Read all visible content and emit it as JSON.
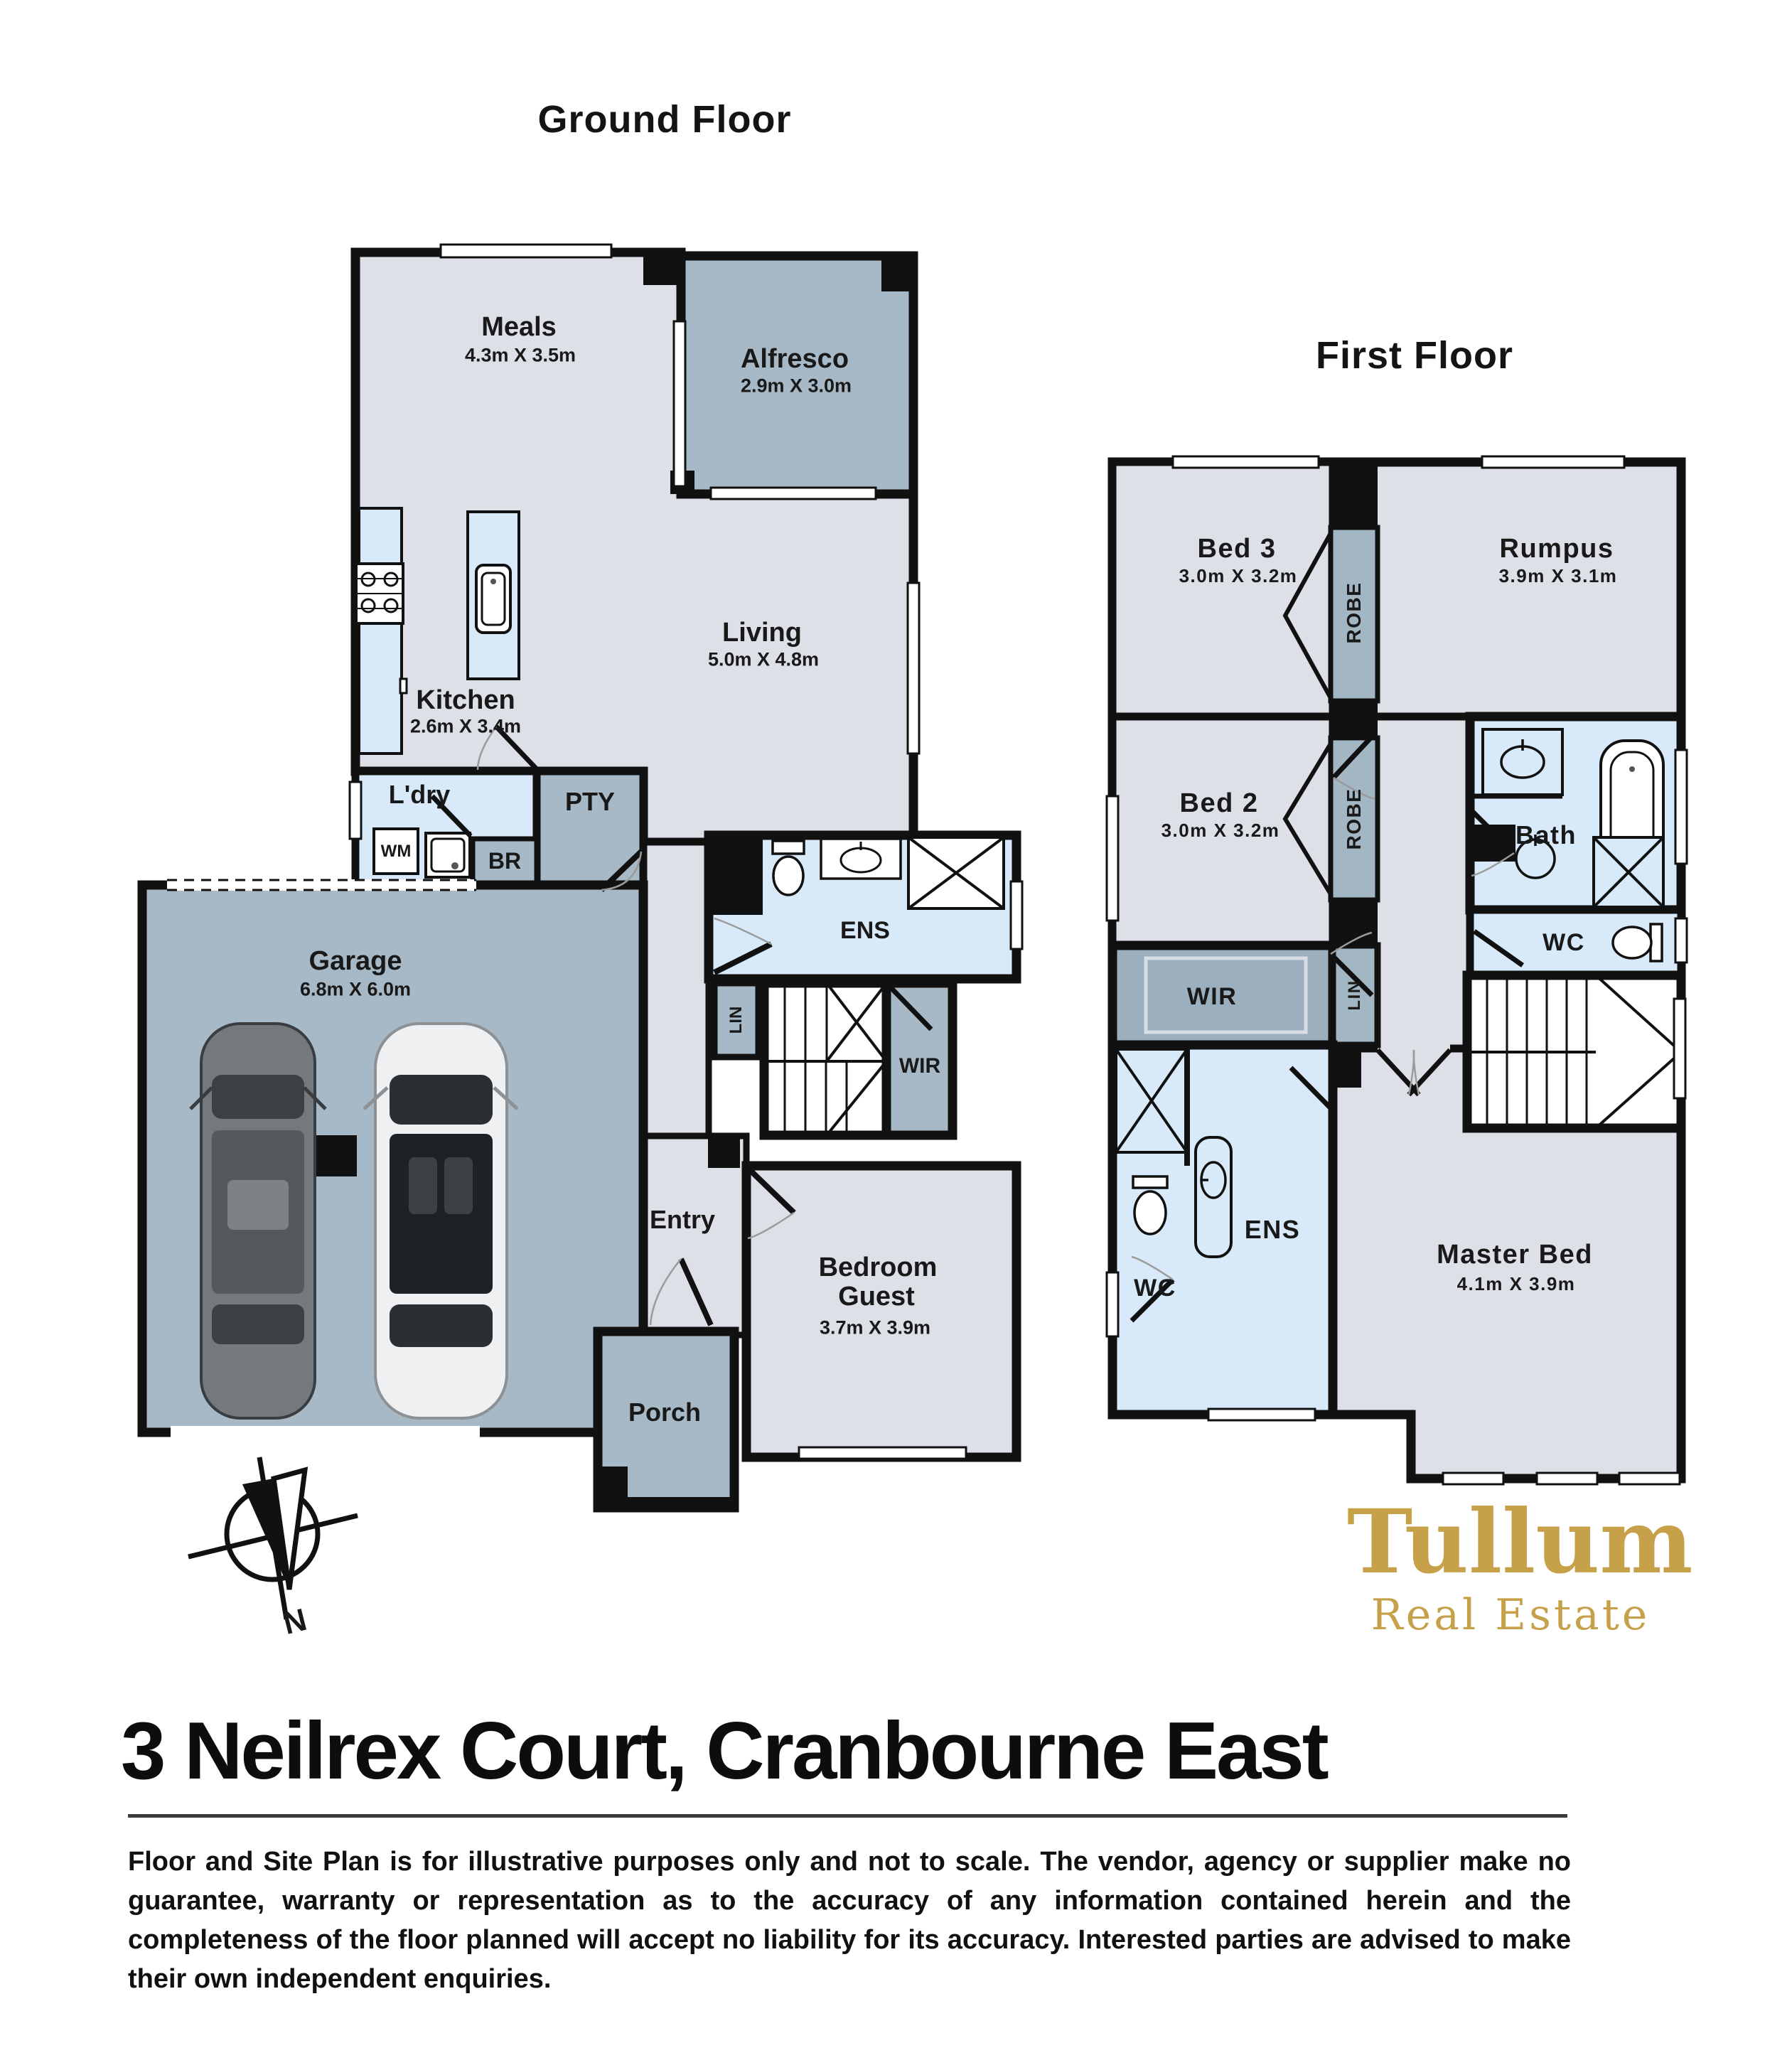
{
  "colors": {
    "wall": "#111111",
    "room_light": "#dde1e7",
    "room_dark": "#a7b9c6",
    "room_wet": "#d8eafa",
    "robe_fill": "#a3b6c3",
    "wir_band": "#9cafbe",
    "brand_gold": "#c7a149",
    "text": "#191919"
  },
  "ground_floor": {
    "title": "Ground Floor",
    "rooms": {
      "meals": {
        "label": "Meals",
        "dims": "4.3m X 3.5m"
      },
      "alfresco": {
        "label": "Alfresco",
        "dims": "2.9m X 3.0m"
      },
      "living": {
        "label": "Living",
        "dims": "5.0m X 4.8m"
      },
      "kitchen": {
        "label": "Kitchen",
        "dims": "2.6m X 3.4m"
      },
      "laundry": {
        "label": "L'dry"
      },
      "pantry": {
        "label": "PTY"
      },
      "washing_machine": {
        "label": "WM"
      },
      "broom": {
        "label": "BR"
      },
      "garage": {
        "label": "Garage",
        "dims": "6.8m X 6.0m"
      },
      "ensuite": {
        "label": "ENS"
      },
      "linen": {
        "label": "LIN"
      },
      "wir": {
        "label": "WIR"
      },
      "entry": {
        "label": "Entry"
      },
      "guest": {
        "label_line1": "Bedroom",
        "label_line2": "Guest",
        "dims": "3.7m X 3.9m"
      },
      "porch": {
        "label": "Porch"
      }
    }
  },
  "first_floor": {
    "title": "First Floor",
    "rooms": {
      "bed3": {
        "label": "Bed 3",
        "dims": "3.0m X 3.2m"
      },
      "robe_bed3": {
        "label": "ROBE"
      },
      "rumpus": {
        "label": "Rumpus",
        "dims": "3.9m X 3.1m"
      },
      "bed2": {
        "label": "Bed 2",
        "dims": "3.0m X 3.2m"
      },
      "robe_bed2": {
        "label": "ROBE"
      },
      "bath": {
        "label": "Bath"
      },
      "wc_bath": {
        "label": "WC"
      },
      "wir": {
        "label": "WIR"
      },
      "linen": {
        "label": "LIN"
      },
      "ensuite": {
        "label": "ENS"
      },
      "wc_ensuite": {
        "label": "WC"
      },
      "master": {
        "label": "Master Bed",
        "dims": "4.1m X 3.9m"
      }
    }
  },
  "compass": {
    "label": "N"
  },
  "branding": {
    "name": "Tullum",
    "tagline": "Real Estate"
  },
  "address": {
    "text": "3 Neilrex Court, Cranbourne East"
  },
  "disclaimer": {
    "text": "Floor and Site Plan is for illustrative purposes only and not to scale.  The vendor, agency or supplier make no guarantee, warranty or representation as to the accuracy of any information contained herein and the completeness of the floor planned will accept no liability for its accuracy.  Interested parties are advised to make their own independent enquiries."
  }
}
